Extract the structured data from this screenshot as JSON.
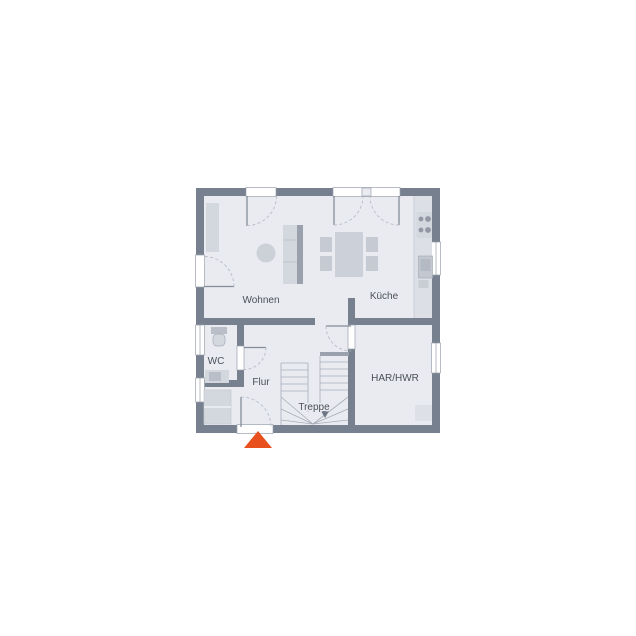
{
  "colors": {
    "wall": "#76808E",
    "floor": "#E9EBF1",
    "accent": "#E8501E",
    "furniture": "#D3D7DE",
    "furniture_shade": "#9AA1AD",
    "line": "#A7ADB8",
    "label": "#4B5058",
    "frame_stroke": "#9AA1AD",
    "leaf": "#858C98",
    "arc": "#B6BCC6"
  },
  "rooms": {
    "wohnen": {
      "label": "Wohnen"
    },
    "kueche": {
      "label": "Küche"
    },
    "wc": {
      "label": "WC"
    },
    "flur": {
      "label": "Flur"
    },
    "treppe": {
      "label": "Treppe"
    },
    "har_hwr": {
      "label": "HAR/HWR"
    }
  },
  "entrance_marker": {
    "shape": "triangle-up",
    "color": "#E8501E"
  }
}
